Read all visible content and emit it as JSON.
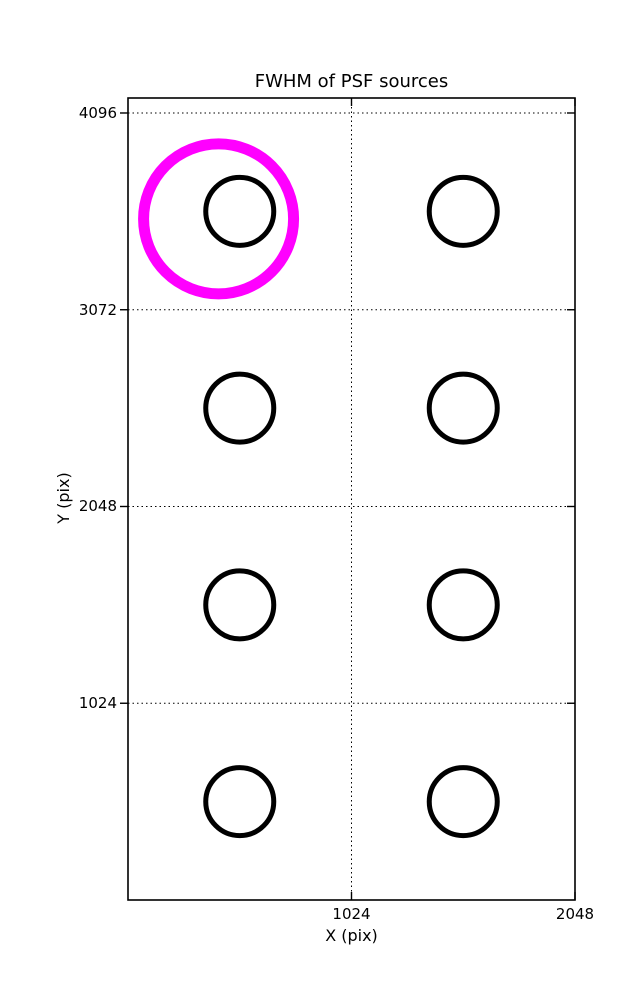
{
  "chart_data": {
    "type": "scatter",
    "title": "FWHM of PSF sources",
    "xlabel": "X (pix)",
    "ylabel": "Y (pix)",
    "xlim": [
      0,
      2048
    ],
    "ylim": [
      0,
      4174
    ],
    "xticks": [
      1024,
      2048
    ],
    "yticks": [
      1024,
      2048,
      3072,
      4096
    ],
    "grid": {
      "visible": true,
      "style": "dotted",
      "color": "#000000"
    },
    "axis_color": "#000000",
    "background_color": "#ffffff",
    "series": [
      {
        "name": "psf-source",
        "label": "PSF source FWHM markers",
        "marker": "circle-outline",
        "color": "#000000",
        "radius_px": 34,
        "stroke_px": 5,
        "points": [
          {
            "x": 512,
            "y": 3584
          },
          {
            "x": 1536,
            "y": 3584
          },
          {
            "x": 512,
            "y": 2560
          },
          {
            "x": 1536,
            "y": 2560
          },
          {
            "x": 512,
            "y": 1536
          },
          {
            "x": 1536,
            "y": 1536
          },
          {
            "x": 512,
            "y": 512
          },
          {
            "x": 1536,
            "y": 512
          }
        ]
      },
      {
        "name": "highlighted-source",
        "label": "Highlighted PSF source",
        "marker": "circle-outline",
        "color": "#ff00ff",
        "radius_px": 75,
        "stroke_px": 11,
        "points": [
          {
            "x": 415,
            "y": 3545
          }
        ]
      }
    ]
  }
}
